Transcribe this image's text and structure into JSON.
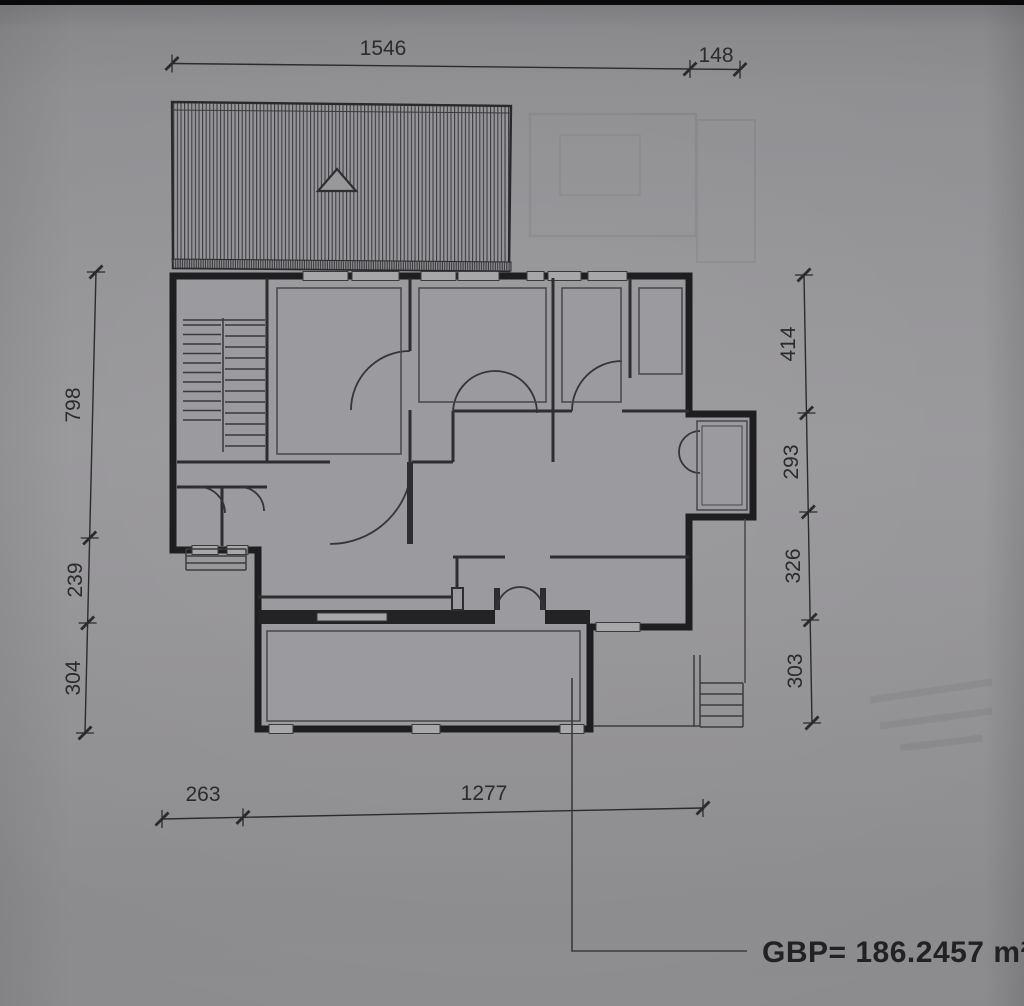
{
  "floor_plan": {
    "area_leader_label": "GBP= 186.2457 m²",
    "dimensions": {
      "top": [
        "1546",
        "148"
      ],
      "left": [
        "798",
        "239",
        "304"
      ],
      "right": [
        "414",
        "293",
        "326",
        "303"
      ],
      "bottom": [
        "263",
        "1277"
      ]
    },
    "colors": {
      "paper": "#97969a",
      "ink": "#2b2b2d",
      "wall": "#1e1e20"
    }
  }
}
